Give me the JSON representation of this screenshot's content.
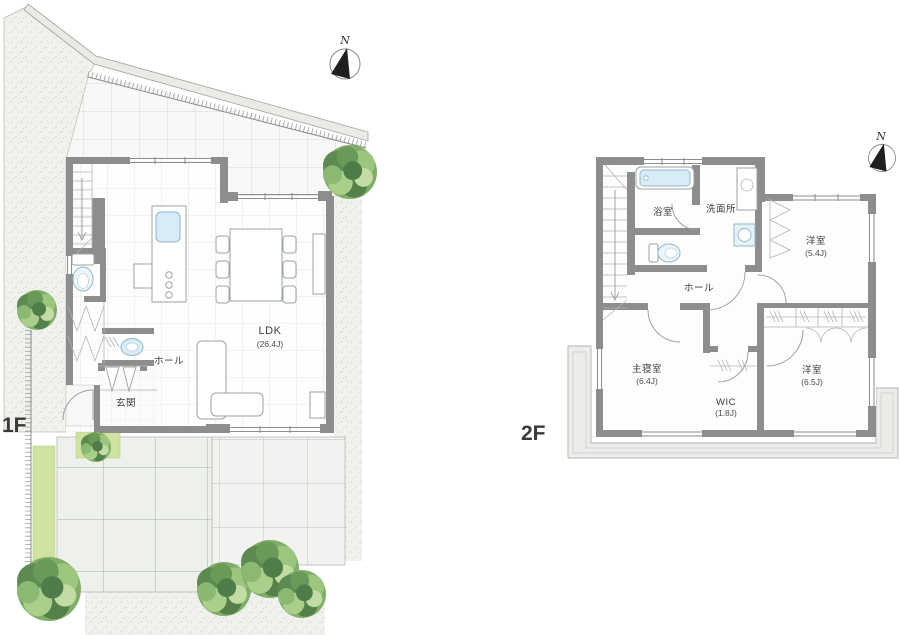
{
  "title": "Residential floor plan, 1F and 2F",
  "floors": [
    {
      "label": "1F",
      "north": "N",
      "rooms": [
        {
          "name": "LDK",
          "area": "(26.4J)"
        },
        {
          "name": "ホール",
          "area": ""
        },
        {
          "name": "玄関",
          "area": ""
        }
      ]
    },
    {
      "label": "2F",
      "north": "N",
      "rooms": [
        {
          "name": "浴室",
          "area": ""
        },
        {
          "name": "洗面所",
          "area": ""
        },
        {
          "name": "洋室",
          "area": "(5.4J)"
        },
        {
          "name": "ホール",
          "area": ""
        },
        {
          "name": "主寝室",
          "area": "(6.4J)"
        },
        {
          "name": "WIC",
          "area": "(1.8J)"
        },
        {
          "name": "洋室",
          "area": "(6.5J)"
        }
      ]
    }
  ],
  "palette": {
    "wall": "#8d8d8d",
    "thin_line": "#9aa3a1",
    "water_fixture": "#d8ecf6",
    "lawn": "#cfe2a0",
    "tree_dark": "#55854d",
    "tree_mid": "#7fae67",
    "tree_light": "#a9cf8b",
    "balcony": "#ececea",
    "stipple_bg": "#f1f1ee",
    "text": "#3d3d3d"
  }
}
